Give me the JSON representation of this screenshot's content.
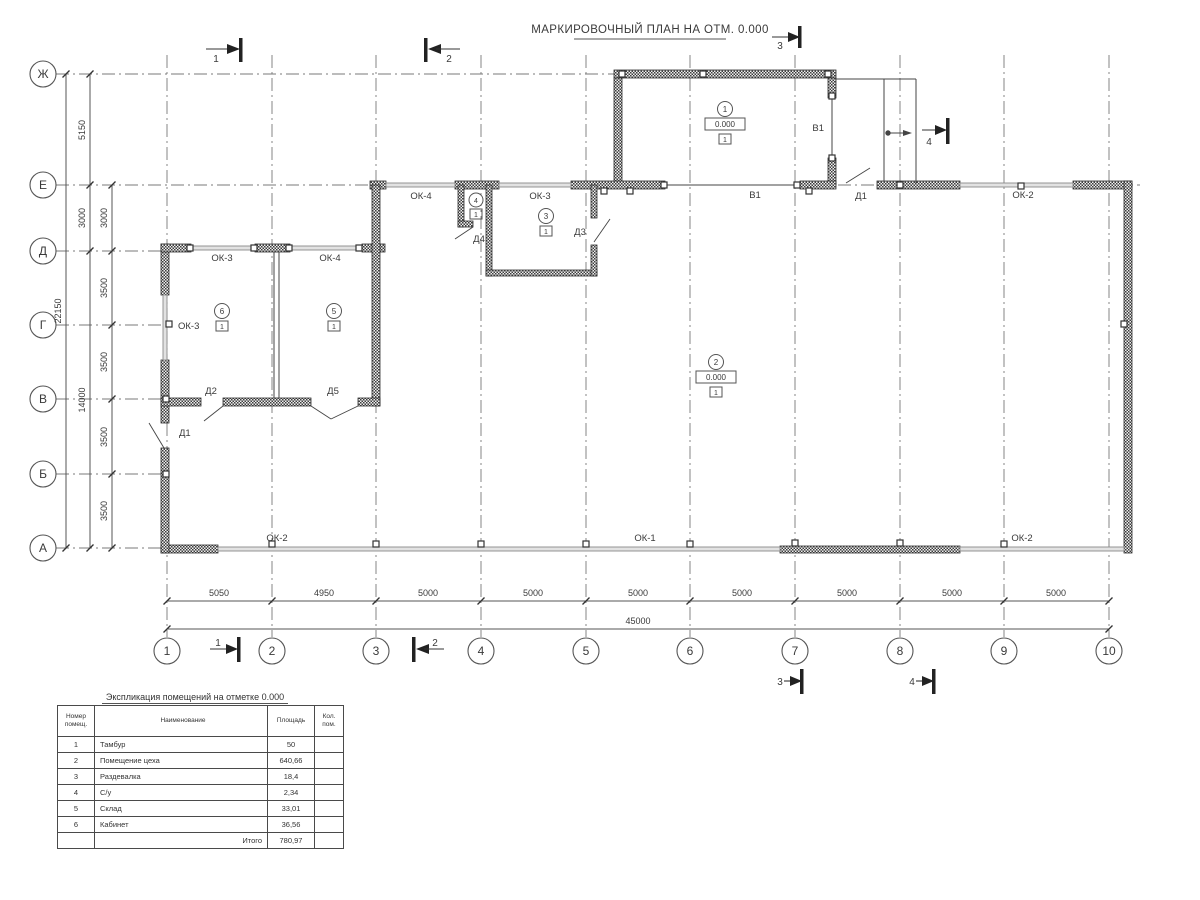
{
  "title": "МАРКИРОВОЧНЫЙ ПЛАН НА ОТМ. 0.000",
  "grid_rows": [
    "Ж",
    "Е",
    "Д",
    "Г",
    "В",
    "Б",
    "А"
  ],
  "grid_cols": [
    "1",
    "2",
    "3",
    "4",
    "5",
    "6",
    "7",
    "8",
    "9",
    "10"
  ],
  "dims": {
    "total_height": "22150",
    "left_mid": [
      "5150",
      "3000",
      "14000"
    ],
    "left_inner": [
      "3000",
      "3500",
      "3500",
      "3500",
      "3500"
    ],
    "bottom": [
      "5050",
      "4950",
      "5000",
      "5000",
      "5000",
      "5000",
      "5000",
      "5000",
      "5000"
    ],
    "total_width": "45000"
  },
  "sections": {
    "s1": "1",
    "s2": "2",
    "s3": "3",
    "s4": "4"
  },
  "openings": {
    "ok1": "ОК-1",
    "ok2": "ОК-2",
    "ok3": "ОК-3",
    "ok4": "ОК-4",
    "v1": "В1",
    "d1": "Д1",
    "d2": "Д2",
    "d3": "Д3",
    "d4": "Д4",
    "d5": "Д5"
  },
  "rooms": {
    "r1": {
      "num": "1",
      "elev": "0.000",
      "floor": "1"
    },
    "r2": {
      "num": "2",
      "elev": "0.000",
      "floor": "1"
    },
    "r3": {
      "num": "3",
      "floor": "1"
    },
    "r4": {
      "num": "4",
      "floor": "1"
    },
    "r5": {
      "num": "5",
      "floor": "1"
    },
    "r6": {
      "num": "6",
      "floor": "1"
    }
  },
  "table": {
    "title": "Экспликация помещений на отметке 0.000",
    "headers": [
      "Номер\nпомещ.",
      "Наименование",
      "Площадь",
      "Кол.\nпом."
    ],
    "rows": [
      {
        "num": "1",
        "name": "Тамбур",
        "area": "50",
        "qty": ""
      },
      {
        "num": "2",
        "name": "Помещение цеха",
        "area": "640,66",
        "qty": ""
      },
      {
        "num": "3",
        "name": "Раздевалка",
        "area": "18,4",
        "qty": ""
      },
      {
        "num": "4",
        "name": "С/у",
        "area": "2,34",
        "qty": ""
      },
      {
        "num": "5",
        "name": "Склад",
        "area": "33,01",
        "qty": ""
      },
      {
        "num": "6",
        "name": "Кабинет",
        "area": "36,56",
        "qty": ""
      }
    ],
    "total_label": "Итого",
    "total_value": "780,97"
  }
}
